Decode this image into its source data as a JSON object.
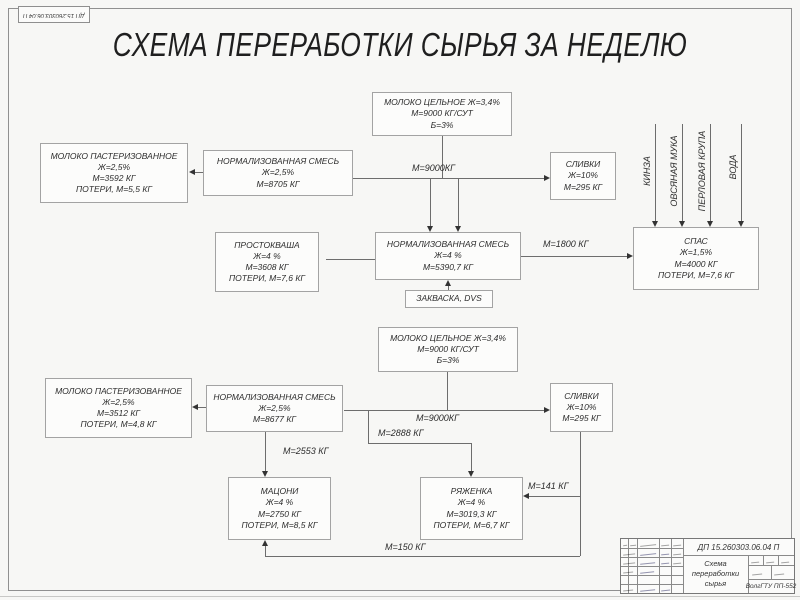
{
  "page": {
    "title": "СХЕМА ПЕРЕРАБОТКИ СЫРЬЯ ЗА НЕДЕЛЮ"
  },
  "nodes": {
    "whole_milk_1": {
      "lines": [
        "МОЛОКО ЦЕЛЬНОЕ Ж=3,4%",
        "М=9000 КГ/СУТ",
        "Б=3%"
      ]
    },
    "past_milk_1": {
      "lines": [
        "МОЛОКО ПАСТЕРИЗОВАННОЕ",
        "Ж=2,5%",
        "М=3592 КГ",
        "ПОТЕРИ, М=5,5 КГ"
      ]
    },
    "norm_mix_1": {
      "lines": [
        "НОРМАЛИЗОВАННАЯ СМЕСЬ",
        "Ж=2,5%",
        "М=8705 КГ"
      ]
    },
    "cream_1": {
      "lines": [
        "СЛИВКИ",
        "Ж=10%",
        "М=295 КГ"
      ]
    },
    "prostokvasha": {
      "lines": [
        "ПРОСТОКВАША",
        "Ж=4 %",
        "М=3608 КГ",
        "ПОТЕРИ, М=7,6 КГ"
      ]
    },
    "norm_mix_2": {
      "lines": [
        "НОРМАЛИЗОВАННАЯ СМЕСЬ",
        "Ж=4 %",
        "М=5390,7 КГ"
      ]
    },
    "spas": {
      "lines": [
        "СПАС",
        "Ж=1,5%",
        "М=4000 КГ",
        "ПОТЕРИ, М=7,6 КГ"
      ]
    },
    "zakvaska": {
      "lines": [
        "ЗАКВАСКА, DVS"
      ]
    },
    "whole_milk_2": {
      "lines": [
        "МОЛОКО ЦЕЛЬНОЕ Ж=3,4%",
        "М=9000 КГ/СУТ",
        "Б=3%"
      ]
    },
    "past_milk_2": {
      "lines": [
        "МОЛОКО ПАСТЕРИЗОВАННОЕ",
        "Ж=2,5%",
        "М=3512 КГ",
        "ПОТЕРИ, М=4,8 КГ"
      ]
    },
    "norm_mix_3": {
      "lines": [
        "НОРМАЛИЗОВАННАЯ СМЕСЬ",
        "Ж=2,5%",
        "М=8677 КГ"
      ]
    },
    "cream_2": {
      "lines": [
        "СЛИВКИ",
        "Ж=10%",
        "М=295 КГ"
      ]
    },
    "matsoni": {
      "lines": [
        "МАЦОНИ",
        "Ж=4 %",
        "М=2750 КГ",
        "ПОТЕРИ, М=8,5 КГ"
      ]
    },
    "ryazhenka": {
      "lines": [
        "РЯЖЕНКА",
        "Ж=4 %",
        "М=3019,3 КГ",
        "ПОТЕРИ, М=6,7 КГ"
      ]
    }
  },
  "flow_labels": {
    "top_milk": "М=9000КГ",
    "to_spas": "М=1800 КГ",
    "bottom_milk": "М=9000КГ",
    "to_ryazhenka": "М=2888 КГ",
    "to_matsoni": "М=2553 КГ",
    "cream_to_ryazhenka": "М=141 КГ",
    "cream_to_matsoni": "М=150 КГ"
  },
  "spas_inputs": [
    "КИНЗА",
    "ОВСЯНАЯ МУКА",
    "ПЕРЛОВАЯ КРУПА",
    "ВОДА"
  ],
  "title_block": {
    "doc_number": "ДП 15.260303.06.04 П",
    "doc_title": "Схема переработки сырья",
    "organization": "ВолгГТУ ПП-552"
  }
}
